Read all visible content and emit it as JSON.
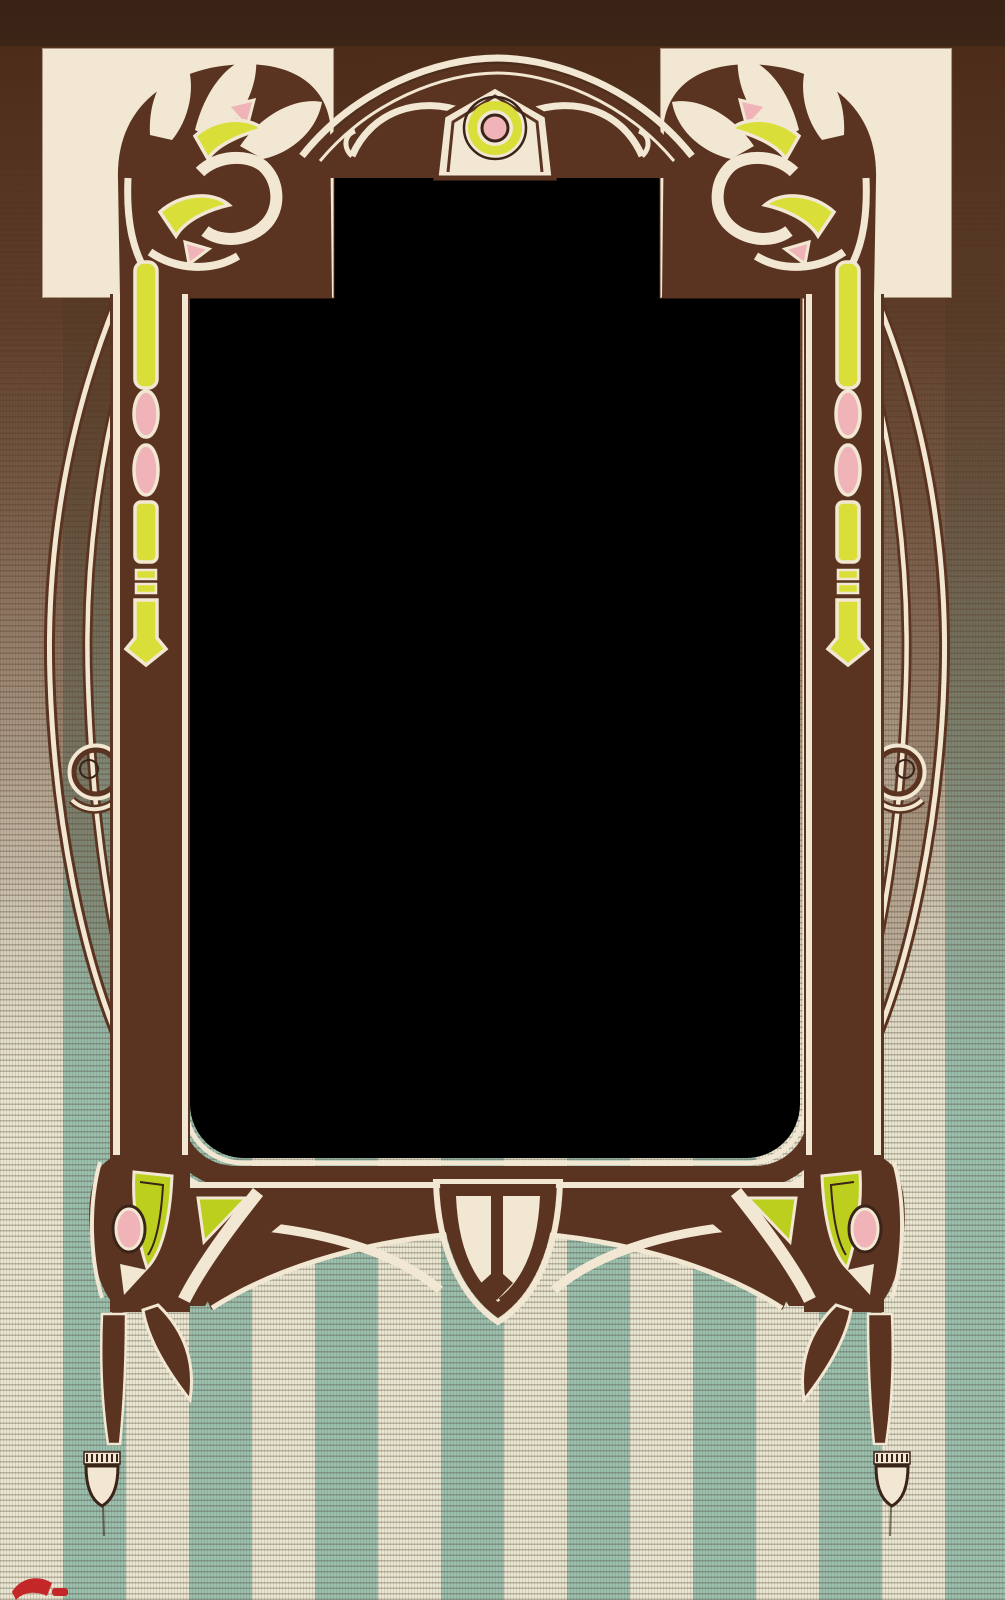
{
  "artwork": {
    "kind": "art-nouveau-postcard-photo-frame",
    "window": {
      "background": "#000000"
    },
    "palette": {
      "frame_brown": "#5a3421",
      "frame_brown_dark": "#3a2318",
      "top_band_brown": "#432617",
      "outline_cream": "#f2e7d2",
      "panel_cream": "#f4ecd9",
      "accent_chartreuse": "#d9df38",
      "accent_green": "#bccf1e",
      "accent_pink": "#f0b3b8",
      "stripe_teal": "#9cbfae",
      "stripe_cream": "#ebe6d2",
      "red_mark": "#c42727"
    },
    "background": {
      "stripe_width_px": 63,
      "stripe_texture": "horizontal hatch on cream stripes, vertical hatch on teal stripes",
      "top_fade": "solid dark brown band fading out toward lower third"
    },
    "ornaments": [
      {
        "name": "corner-scroll-fan-with-tulip-buds",
        "positions": [
          "top-left",
          "top-right"
        ]
      },
      {
        "name": "arch-with-s-hooks",
        "position": "top-center"
      },
      {
        "name": "pediment-medallion-concentric-circles",
        "position": "top-center",
        "rings": [
          "dark ring",
          "chartreuse ring",
          "cream ring",
          "dark ring",
          "pink center"
        ]
      },
      {
        "name": "stem-with-pink-beads-and-arrow-tip",
        "positions": [
          "left-rail",
          "right-rail"
        ]
      },
      {
        "name": "whiplash-teardrop-curves",
        "positions": [
          "left",
          "right"
        ]
      },
      {
        "name": "circle-bud-pink-with-chartreuse-center",
        "positions": [
          "left",
          "right"
        ]
      },
      {
        "name": "corner-knot-with-green-triangles-and-pink-oval",
        "positions": [
          "bottom-left",
          "bottom-right"
        ]
      },
      {
        "name": "shield-pendant-with-trident",
        "position": "bottom-center"
      },
      {
        "name": "spade-drop-finial",
        "positions": [
          "bottom-left",
          "bottom-right"
        ]
      },
      {
        "name": "red-ink-fragment",
        "position": "bottom-left-edge"
      }
    ]
  }
}
